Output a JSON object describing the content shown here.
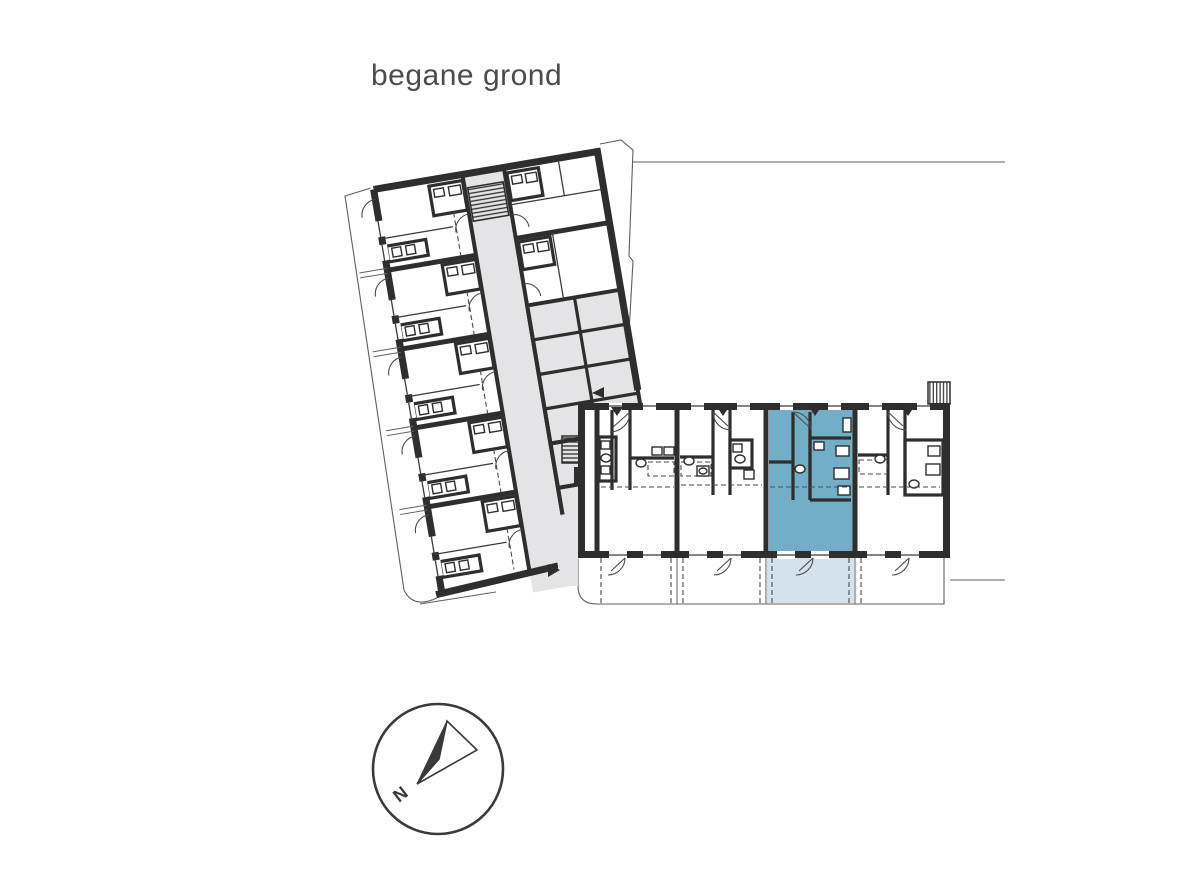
{
  "page": {
    "title": "begane grond"
  },
  "floorplan": {
    "floor_label": "begane grond",
    "wings": {
      "left_wing": "angled residential wing with central corridor, five apartments and storage rooms",
      "right_wing": "horizontal wing with four ground-floor apartments and gardens"
    },
    "highlighted_unit": {
      "description": "selected apartment, third unit of right wing",
      "status": "highlighted"
    }
  },
  "compass": {
    "label": "N"
  },
  "colors": {
    "wall": "#2e2e2e",
    "circulation": "#e4e4e6",
    "unit_highlight": "#73aec9",
    "terrace_highlight": "#d3e2ec",
    "site_line": "#5f5f5f",
    "title_text": "#4c4c4c"
  }
}
